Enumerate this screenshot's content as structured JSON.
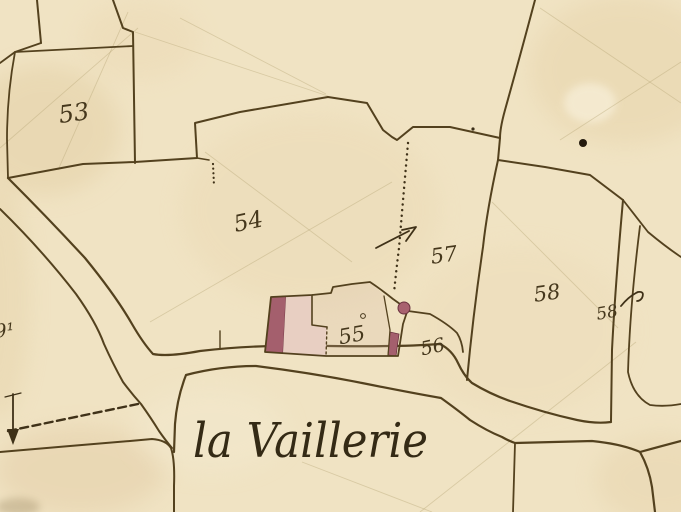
{
  "map": {
    "place_label": "la Vaillerie",
    "parcels": [
      {
        "number": "53"
      },
      {
        "number": "54"
      },
      {
        "number": "55"
      },
      {
        "number": "56"
      },
      {
        "number": "57"
      },
      {
        "number": "58"
      },
      {
        "number": "58"
      },
      {
        "number": "9¹"
      }
    ],
    "colors": {
      "paper": "#f0e3c3",
      "ink": "#53411e",
      "label_ink": "#45371c",
      "place_ink": "#342a15",
      "building_fill": "#e8cfc2",
      "building_accent": "#a45f6d"
    }
  }
}
